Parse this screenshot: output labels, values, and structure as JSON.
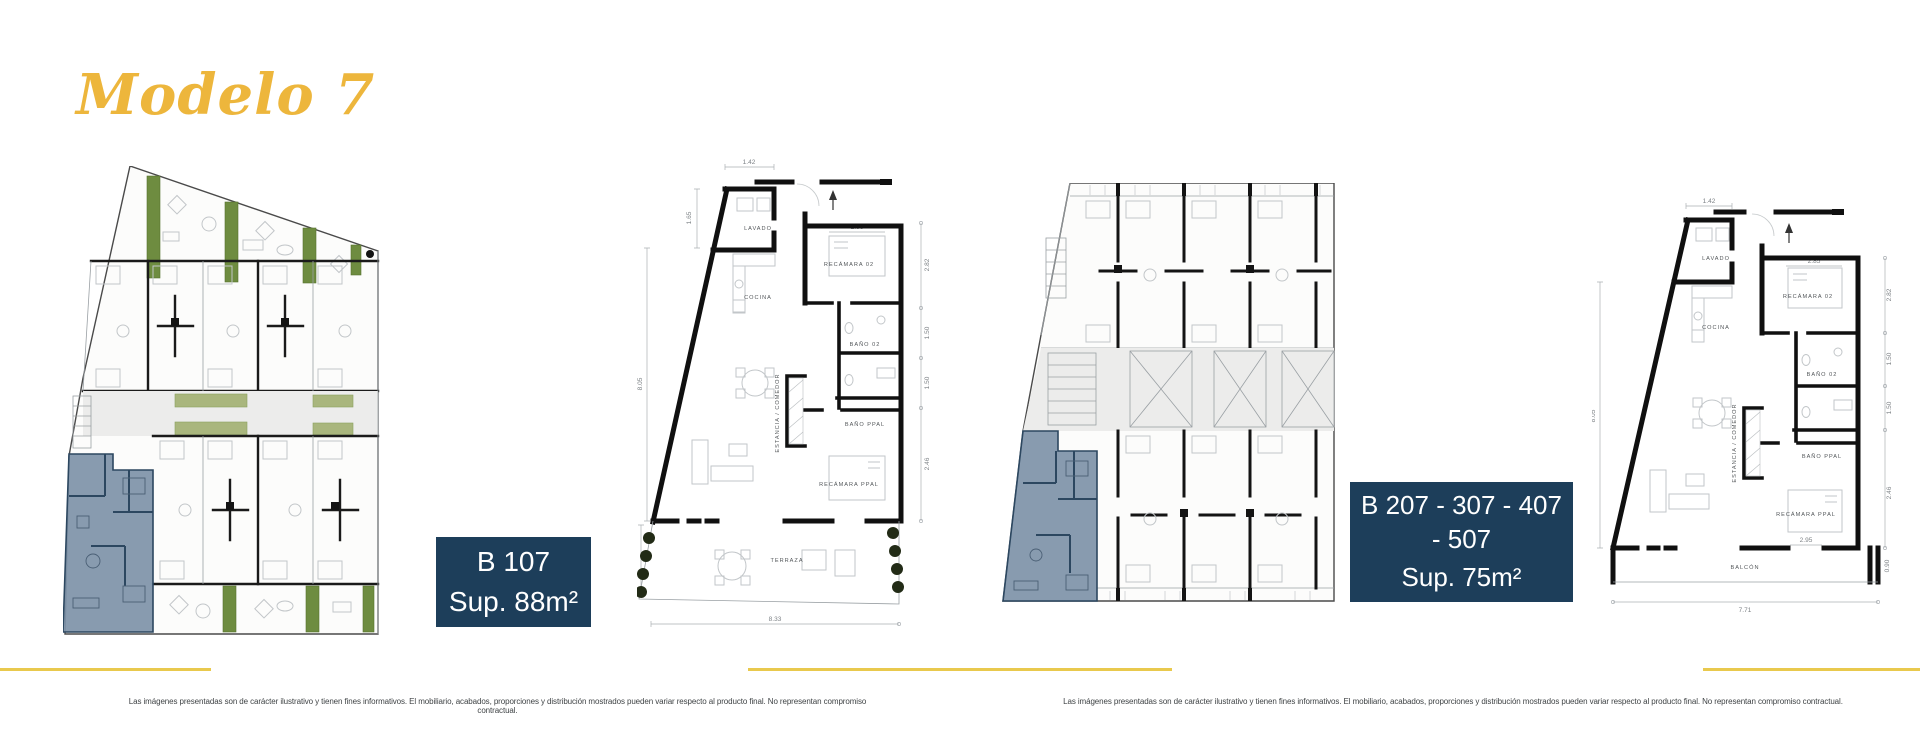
{
  "slide": {
    "title": "Modelo 7"
  },
  "unit_labels": [
    {
      "units": "B 107",
      "area": "Sup. 88m²"
    },
    {
      "units": "B 207 - 307 - 407 - 507",
      "area": "Sup. 75m²"
    }
  ],
  "footer": {
    "disclaimer": "Las imágenes presentadas son de carácter ilustrativo y tienen fines informativos. El mobiliario, acabados, proporciones y distribución mostrados pueden variar respecto al producto final. No representan compromiso contractual."
  },
  "plan_b107": {
    "rooms": {
      "lavado": "LAVADO",
      "cocina": "COCINA",
      "recamara2": "RECÁMARA 02",
      "bano2": "BAÑO 02",
      "bano_ppal": "BAÑO PPAL",
      "estancia": "ESTANCIA / COMEDOR",
      "recamara_ppal": "RECÁMARA PPAL",
      "terraza": "TERRAZA"
    },
    "dims": {
      "top": "1.42",
      "left_top": "1.65",
      "left": "8.05",
      "left_bottom": "2.17",
      "recamara2_width": "2.96",
      "right": [
        "2.82",
        "1.50",
        "1.50",
        "2.46"
      ],
      "bottom": "8.33"
    }
  },
  "plan_b207": {
    "rooms": {
      "lavado": "LAVADO",
      "cocina": "COCINA",
      "recamara2": "RECÁMARA 02",
      "bano2": "BAÑO 02",
      "bano_ppal": "BAÑO PPAL",
      "estancia": "ESTANCIA / COMEDOR",
      "recamara_ppal": "RECÁMARA PPAL",
      "balcon": "BALCÓN"
    },
    "dims": {
      "top": "1.42",
      "left": "8.05",
      "recamara2_width": "2.85",
      "right": [
        "2.82",
        "1.50",
        "1.50",
        "2.46"
      ],
      "bottom": "7.71",
      "door": "2.95",
      "balcon_depth": "0.90"
    }
  },
  "colors": {
    "accent_gold": "#EDB63C",
    "divider_gold": "#E9C94D",
    "label_navy": "#1D3E5A",
    "label_text": "#FFFFFF",
    "highlight_unit": "#7E93A8",
    "highlight_wall": "#2C4760",
    "tree_green": "#6E8C40",
    "planter_green": "#A9B67D"
  }
}
